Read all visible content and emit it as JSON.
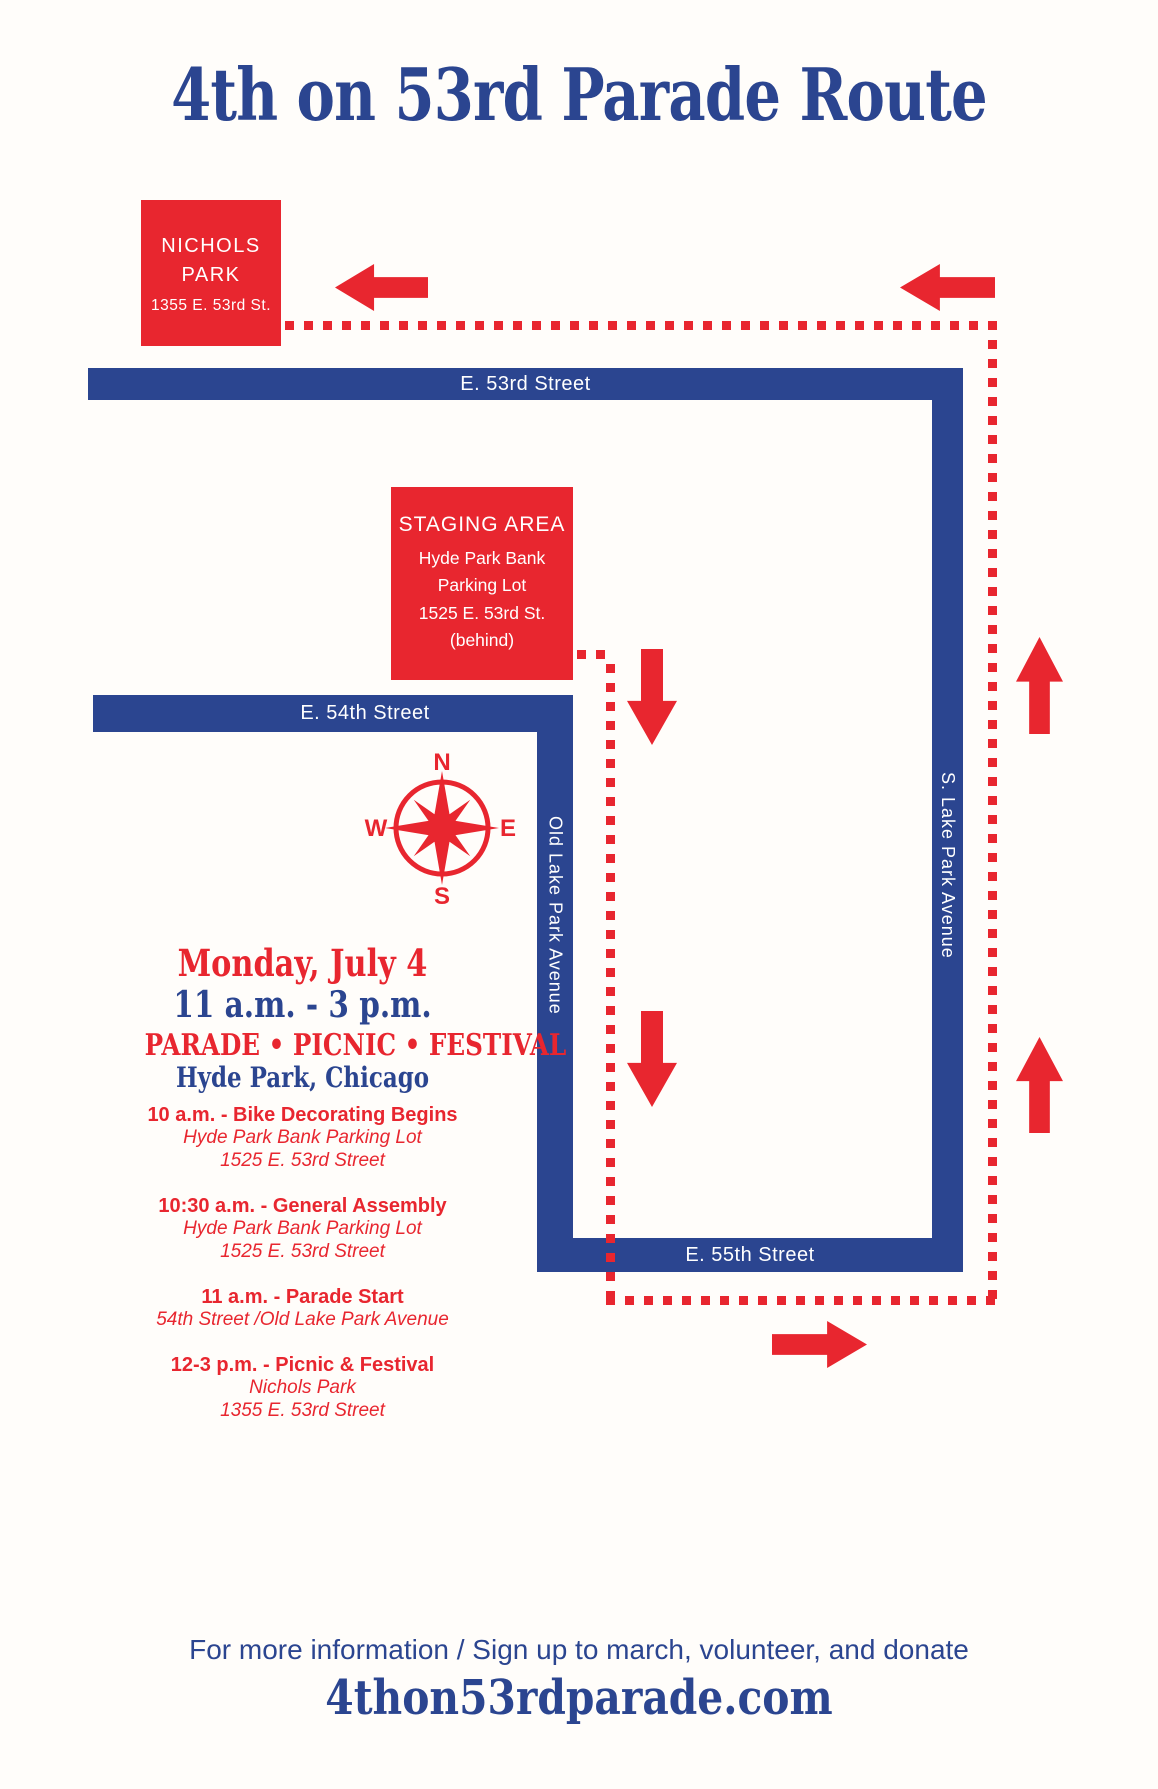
{
  "title": "4th on 53rd Parade Route",
  "colors": {
    "red": "#e8262f",
    "blue": "#2b4590",
    "background": "#fffdfa"
  },
  "map": {
    "nichols_park": {
      "name": "NICHOLS PARK",
      "address": "1355 E. 53rd St."
    },
    "staging_area": {
      "name": "STAGING AREA",
      "line1": "Hyde Park Bank",
      "line2": "Parking Lot",
      "line3": "1525 E. 53rd St.",
      "line4": "(behind)"
    },
    "streets": {
      "e53rd": "E. 53rd Street",
      "e54th": "E. 54th Street",
      "e55th": "E. 55th Street",
      "old_lake_park": "Old Lake Park Avenue",
      "s_lake_park": "S. Lake Park Avenue"
    },
    "compass": {
      "north": "N",
      "east": "E",
      "south": "S",
      "west": "W"
    },
    "icons": {
      "compass": "compass-rose-icon",
      "route_arrow_directions": [
        "left",
        "left",
        "down",
        "down",
        "up",
        "up",
        "right"
      ],
      "route_line_style": "red-dotted"
    }
  },
  "event": {
    "date": "Monday, July 4",
    "time": "11 a.m. - 3 p.m.",
    "tagline": "PARADE • PICNIC • FESTIVAL",
    "location": "Hyde Park, Chicago"
  },
  "schedule": {
    "items": [
      {
        "title": "10 a.m. - Bike Decorating Begins",
        "lines": [
          "Hyde Park Bank Parking Lot",
          "1525 E. 53rd Street"
        ]
      },
      {
        "title": "10:30 a.m. - General Assembly",
        "lines": [
          "Hyde Park Bank Parking Lot",
          "1525 E. 53rd Street"
        ]
      },
      {
        "title": "11 a.m. - Parade Start",
        "lines": [
          "54th Street /Old Lake Park Avenue"
        ]
      },
      {
        "title": "12-3 p.m. - Picnic & Festival",
        "lines": [
          "Nichols Park",
          "1355 E. 53rd Street"
        ]
      }
    ]
  },
  "footer": {
    "info": "For more information / Sign up to march, volunteer, and donate",
    "website": "4thon53rdparade.com"
  }
}
